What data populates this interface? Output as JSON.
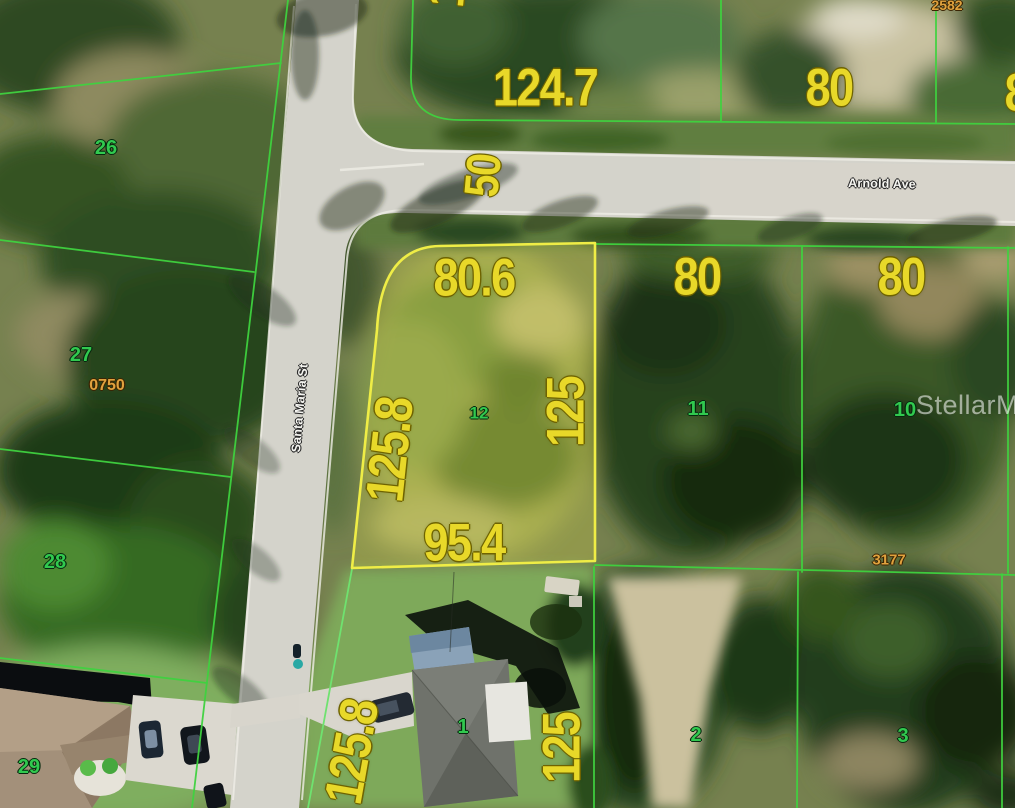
{
  "map": {
    "watermark": "StellarMLS",
    "streets": {
      "horizontal": "Arnold Ave",
      "vertical": "Santa Maria St",
      "road_width": "50"
    },
    "subject_parcel": {
      "lot_number": "12",
      "front_dim": "80.6",
      "west_dim": "125.8",
      "east_dim": "125",
      "rear_dim": "95.4"
    },
    "north_parcels": {
      "corner_front_dim": "124.7",
      "corner_side_dim": "125",
      "mid_front_dim": "80",
      "mid_id": "2582",
      "right_front_dim": "80"
    },
    "east_parcels": {
      "lot11_number": "11",
      "lot11_front_dim": "80",
      "lot10_number": "10",
      "lot10_front_dim": "80",
      "lot10_id": "3177"
    },
    "west_parcels": {
      "lot26": "26",
      "lot27": "27",
      "lot27_id": "0750",
      "lot28": "28",
      "lot29": "29"
    },
    "south_parcels": {
      "lot1_number": "1",
      "lot1_west_dim": "125.8",
      "lot1_east_dim": "125",
      "lot2_number": "2",
      "lot3_number": "3"
    },
    "colors": {
      "parcel_line_green": "#3fd23f",
      "subject_outline_yellow": "#efed46",
      "dimension_text_yellow": "#e8d829",
      "lot_number_green": "#31c94f",
      "parcel_id_orange": "#e0a23e"
    }
  }
}
